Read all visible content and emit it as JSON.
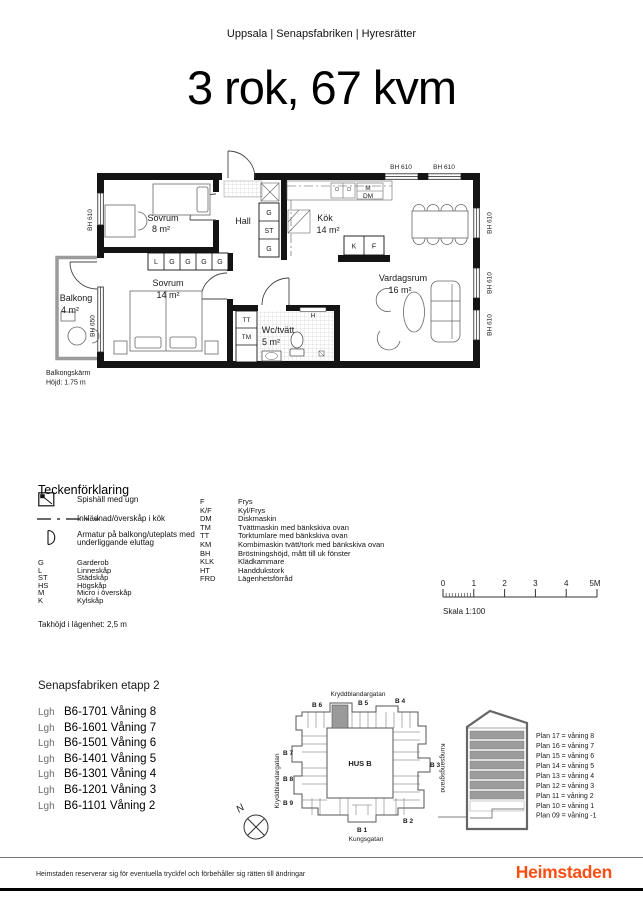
{
  "header": {
    "breadcrumb": "Uppsala | Senapsfabriken | Hyresrätter"
  },
  "title": "3 rok, 67 kvm",
  "floorplan": {
    "rooms": {
      "sovrum8": {
        "name": "Sovrum",
        "area": "8 m²"
      },
      "sovrum14": {
        "name": "Sovrum",
        "area": "14 m²"
      },
      "hall": {
        "name": "Hall"
      },
      "kok": {
        "name": "Kök",
        "area": "14 m²"
      },
      "vardagsrum": {
        "name": "Vardagsrum",
        "area": "16 m²"
      },
      "wc": {
        "name": "Wc/tvätt",
        "area": "5 m²"
      },
      "balkong": {
        "name": "Balkong",
        "area": "4 m²"
      }
    },
    "labels": {
      "bh610": "BH 610",
      "bh650": "BH 650",
      "balcony_screen_line1": "Balkongskärm",
      "balcony_screen_line2": "Höjd: 1.75 m",
      "m": "M",
      "dm": "DM",
      "h": "H",
      "k": "K",
      "f": "F",
      "tt": "TT",
      "tm": "TM"
    },
    "closets_bedroom": [
      "L",
      "G",
      "G",
      "G",
      "G"
    ],
    "closets_hall": [
      "G",
      "ST",
      "G"
    ]
  },
  "legend": {
    "title": "Teckenförklaring",
    "symbols": {
      "stove": "Spishäll med ugn",
      "cladding": "Inklädnad/överskåp i kök",
      "lamp": "Armatur på balkong/uteplats med underliggande eluttag"
    },
    "abbrev_left": [
      {
        "abbr": "G",
        "desc": "Garderob"
      },
      {
        "abbr": "L",
        "desc": "Linneskåp"
      },
      {
        "abbr": "ST",
        "desc": "Städskåp"
      },
      {
        "abbr": "HS",
        "desc": "Högskåp"
      },
      {
        "abbr": "M",
        "desc": "Micro i överskåp"
      },
      {
        "abbr": "K",
        "desc": "Kylskåp"
      }
    ],
    "abbrev_right": [
      {
        "abbr": "F",
        "desc": "Frys"
      },
      {
        "abbr": "K/F",
        "desc": "Kyl/Frys"
      },
      {
        "abbr": "DM",
        "desc": "Diskmaskin"
      },
      {
        "abbr": "TM",
        "desc": "Tvättmaskin med bänkskiva ovan"
      },
      {
        "abbr": "TT",
        "desc": "Torktumlare med bänkskiva ovan"
      },
      {
        "abbr": "KM",
        "desc": "Kombimaskin tvätt/tork med bänkskiva ovan"
      },
      {
        "abbr": "BH",
        "desc": "Bröstningshöjd, mått till uk fönster"
      },
      {
        "abbr": "KLK",
        "desc": "Klädkammare"
      },
      {
        "abbr": "HT",
        "desc": "Handdukstork"
      },
      {
        "abbr": "FRD",
        "desc": "Lägenhetsförråd"
      }
    ],
    "ceiling_note": "Takhöjd i lägenhet: 2,5 m"
  },
  "scalebar": {
    "ticks": [
      "0",
      "1",
      "2",
      "3",
      "4",
      "5M"
    ],
    "label": "Skala 1:100"
  },
  "listing": {
    "title": "Senapsfabriken etapp 2",
    "apartments": [
      {
        "prefix": "Lgh",
        "id": "B6-1701",
        "floor": "Våning 8"
      },
      {
        "prefix": "Lgh",
        "id": "B6-1601",
        "floor": "Våning 7"
      },
      {
        "prefix": "Lgh",
        "id": "B6-1501",
        "floor": "Våning 6"
      },
      {
        "prefix": "Lgh",
        "id": "B6-1401",
        "floor": "Våning 5"
      },
      {
        "prefix": "Lgh",
        "id": "B6-1301",
        "floor": "Våning 4"
      },
      {
        "prefix": "Lgh",
        "id": "B6-1201",
        "floor": "Våning 3"
      },
      {
        "prefix": "Lgh",
        "id": "B6-1101",
        "floor": "Våning 2"
      }
    ]
  },
  "sitemap": {
    "streets": {
      "top": "Kryddblandargatan",
      "left": "Kryddblandargatan",
      "bottom": "Kungsgatan",
      "right": "Kungsängsgränd"
    },
    "building_label": "HUS B",
    "entrances": {
      "b1": "B 1",
      "b2": "B 2",
      "b3": "B 3",
      "b4": "B 4",
      "b5": "B 5",
      "b6": "B 6",
      "b7": "B 7",
      "b8": "B 8",
      "b9": "B 9"
    },
    "compass": "N",
    "highlight_color": "#9a9a9a"
  },
  "elevation": {
    "floors": [
      "Plan 17 = våning 8",
      "Plan 16 = våning 7",
      "Plan 15 = våning 6",
      "Plan 14 = våning 5",
      "Plan 13 = våning 4",
      "Plan 12 = våning 3",
      "Plan 11 = våning 2",
      "Plan 10 = våning 1",
      "Plan 09 = våning -1"
    ]
  },
  "footer": {
    "disclaimer": "Heimstaden reserverar sig för eventuella tryckfel och förbehåller sig rätten till ändringar",
    "logo": "Heimstaden"
  },
  "colors": {
    "brand_orange": "#FA4E14",
    "floor_gray": "#9c9c9c"
  }
}
